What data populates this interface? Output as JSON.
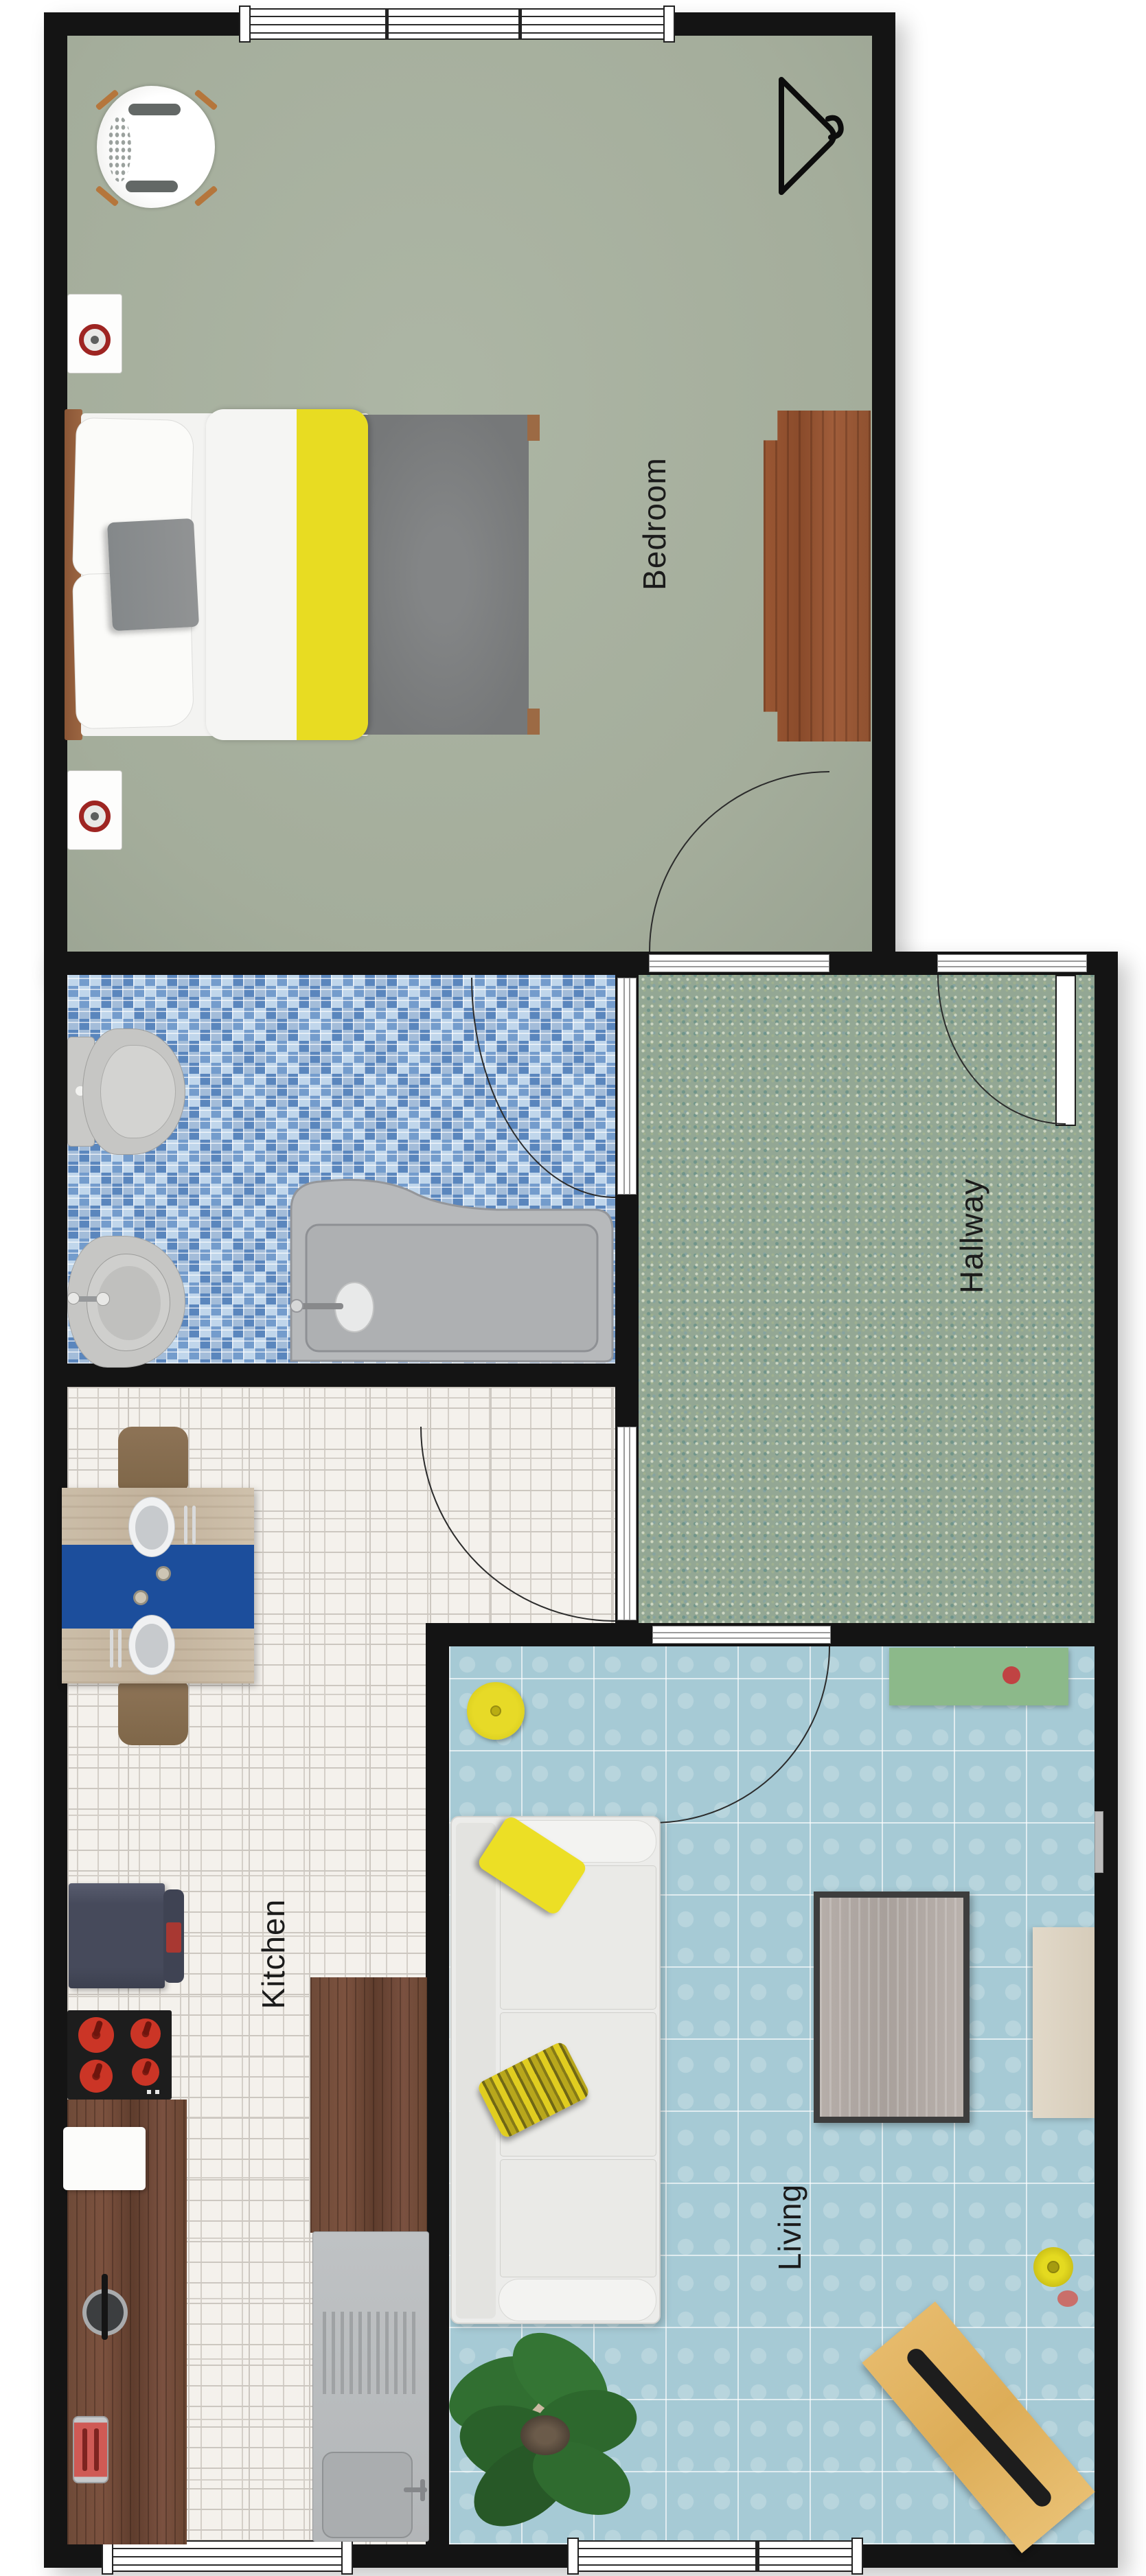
{
  "rooms": {
    "bedroom": {
      "label": "Bedroom"
    },
    "hallway": {
      "label": "Hallway"
    },
    "kitchen": {
      "label": "Kitchen"
    },
    "living": {
      "label": "Living"
    }
  },
  "palette": {
    "wall": "#141414",
    "bedroom_floor_sage": "#aab3a1",
    "bathroom_mosaic_blue": "#9cbede",
    "hallway_mosaic_green": "#93a794",
    "kitchen_tile_white": "#f4f1ec",
    "living_tile_blue": "#a6cad5",
    "accent_yellow": "#e8de1f",
    "table_runner_blue": "#1c4e9c",
    "tv_bench_green": "#8cb98a",
    "counter_wood_dark": "#6e4a38",
    "dresser_wood_sienna": "#9a5733",
    "lounge_chair_tan": "#e2b264",
    "fridge_navy": "#4b4f60",
    "accent_red": "#b03430",
    "fixture_gray": "#c6c6c4"
  },
  "furniture": {
    "bedroom": [
      "shell-chair",
      "speaker",
      "speaker",
      "double-bed",
      "dresser",
      "hanger-icon"
    ],
    "bathroom": [
      "toilet",
      "bidet",
      "bathtub"
    ],
    "kitchen": [
      "dining-table",
      "chair",
      "chair",
      "fridge",
      "cooktop",
      "counter",
      "cutting-board",
      "pot",
      "toaster",
      "sink-counter",
      "sink"
    ],
    "living": [
      "tv-bench",
      "pouf",
      "sofa",
      "coffee-table",
      "side-table",
      "floor-lamp",
      "lounge-chair",
      "plant"
    ]
  }
}
